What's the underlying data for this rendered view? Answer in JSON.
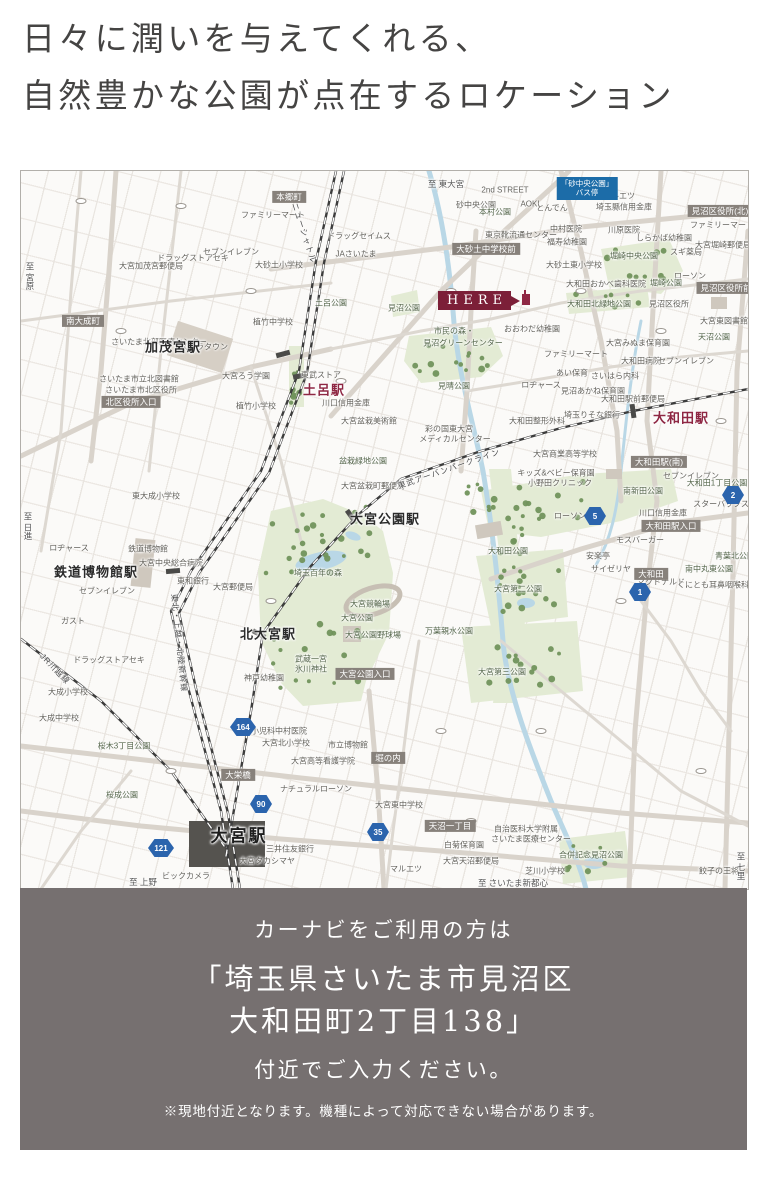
{
  "header": {
    "line1": "日々に潤いを与えてくれる、",
    "line2": "自然豊かな公園が点在するロケーション"
  },
  "footer": {
    "line1": "カーナビをご利用の方は",
    "line2": "「埼玉県さいたま市見沼区",
    "line3": "大和田町2丁目138」",
    "line4": "付近でご入力ください。",
    "note": "※現地付近となります。機種によって対応できない場合があります。"
  },
  "colors": {
    "accent_red": "#7c1f38",
    "station_red": "#8e2743",
    "badge_gray": "#87817b",
    "route_blue": "#2b64ad",
    "footer_bg": "#767070",
    "park_green": "#e3ebd4",
    "tree_green": "#71945c",
    "water_blue": "#b9d7e6"
  },
  "map": {
    "here": {
      "label": "HERE"
    },
    "stations": [
      {
        "t": "加茂宮駅",
        "cls": "sta",
        "x": 152,
        "y": 175
      },
      {
        "t": "土呂駅",
        "cls": "sta-red",
        "x": 303,
        "y": 218
      },
      {
        "t": "大和田駅",
        "cls": "sta-red",
        "x": 660,
        "y": 246
      },
      {
        "t": "鉄道博物館駅",
        "cls": "sta",
        "x": 75,
        "y": 400
      },
      {
        "t": "北大宮駅",
        "cls": "sta",
        "x": 247,
        "y": 462
      },
      {
        "t": "大宮公園駅",
        "cls": "sta",
        "x": 364,
        "y": 347
      },
      {
        "t": "大宮駅",
        "cls": "sta-big",
        "x": 218,
        "y": 663
      }
    ],
    "gray_badges": [
      {
        "t": "本郷町",
        "x": 268,
        "y": 26
      },
      {
        "t": "南大成町",
        "x": 62,
        "y": 150
      },
      {
        "t": "北区役所入口",
        "x": 110,
        "y": 231
      },
      {
        "t": "大砂土中学校前",
        "x": 465,
        "y": 78
      },
      {
        "t": "見沼区役所(北)",
        "x": 699,
        "y": 40
      },
      {
        "t": "見沼区役所前",
        "x": 705,
        "y": 117
      },
      {
        "t": "大宮公園入口",
        "x": 344,
        "y": 503
      },
      {
        "t": "大和田駅(南)",
        "x": 638,
        "y": 291
      },
      {
        "t": "大和田駅入口",
        "x": 650,
        "y": 355
      },
      {
        "t": "大和田",
        "x": 630,
        "y": 403
      },
      {
        "t": "大栄橋",
        "x": 217,
        "y": 604
      },
      {
        "t": "堀の内",
        "x": 367,
        "y": 587
      },
      {
        "t": "天沼一丁目",
        "x": 429,
        "y": 655
      }
    ],
    "route_badges": [
      {
        "n": "90",
        "x": 240,
        "y": 633
      },
      {
        "n": "121",
        "x": 140,
        "y": 677
      },
      {
        "n": "35",
        "x": 357,
        "y": 661
      },
      {
        "n": "164",
        "x": 222,
        "y": 556
      },
      {
        "n": "2",
        "x": 712,
        "y": 324
      },
      {
        "n": "5",
        "x": 574,
        "y": 345
      },
      {
        "n": "1",
        "x": 619,
        "y": 421
      }
    ],
    "bus_badge": {
      "l1": "「砂中央公園」",
      "l2": "バス停",
      "x": 566,
      "y": 6
    },
    "rail_names": [
      {
        "t": "ニューシャトル",
        "x": 283,
        "y": 62,
        "r": 72
      },
      {
        "t": "JR川越線",
        "x": 34,
        "y": 498,
        "r": 46
      },
      {
        "t": "東北・上越・北陸新幹線",
        "x": 158,
        "y": 472,
        "r": 84
      },
      {
        "t": "東武アーバンパークライン",
        "x": 428,
        "y": 298,
        "r": -19
      }
    ],
    "directions": [
      {
        "t": "至 東大宮",
        "x": 425,
        "y": 13,
        "v": false
      },
      {
        "t": "至 宮原",
        "x": 9,
        "y": 105,
        "v": true
      },
      {
        "t": "至 日進",
        "x": 7,
        "y": 355,
        "v": true
      },
      {
        "t": "至 上野",
        "x": 122,
        "y": 711,
        "v": false
      },
      {
        "t": "至 さいたま新都心",
        "x": 492,
        "y": 712,
        "v": false
      },
      {
        "t": "至 七里",
        "x": 720,
        "y": 695,
        "v": true
      }
    ],
    "parks": [
      {
        "t": "見沼公園",
        "x": 383,
        "y": 137
      },
      {
        "t": "市民の森・",
        "x": 433,
        "y": 160
      },
      {
        "t": "見沼グリーンセンター",
        "x": 442,
        "y": 172
      },
      {
        "t": "見晴公園",
        "x": 433,
        "y": 215
      },
      {
        "t": "大和田北緑地公園",
        "x": 578,
        "y": 133
      },
      {
        "t": "堀崎中央公園",
        "x": 613,
        "y": 85
      },
      {
        "t": "堀崎公園",
        "x": 645,
        "y": 112
      },
      {
        "t": "大和田公園",
        "x": 487,
        "y": 380
      },
      {
        "t": "大宮第二公園",
        "x": 497,
        "y": 418
      },
      {
        "t": "大宮第三公園",
        "x": 481,
        "y": 501
      },
      {
        "t": "万葉親水公園",
        "x": 428,
        "y": 460
      },
      {
        "t": "埼玉百年の森",
        "x": 297,
        "y": 402
      },
      {
        "t": "大宮競輪場",
        "x": 349,
        "y": 433
      },
      {
        "t": "大宮公園",
        "x": 336,
        "y": 447
      },
      {
        "t": "大宮公園野球場",
        "x": 352,
        "y": 464
      },
      {
        "t": "武蔵一宮",
        "x": 290,
        "y": 488
      },
      {
        "t": "氷川神社",
        "x": 290,
        "y": 498
      },
      {
        "t": "合併記念見沼公園",
        "x": 570,
        "y": 684
      },
      {
        "t": "本村公園",
        "x": 474,
        "y": 41
      },
      {
        "t": "土呂公園",
        "x": 310,
        "y": 132
      },
      {
        "t": "大和田1丁目公園",
        "x": 696,
        "y": 312
      },
      {
        "t": "南新田公園",
        "x": 622,
        "y": 320
      },
      {
        "t": "天沼公園",
        "x": 693,
        "y": 166
      },
      {
        "t": "盆栽緑地公園",
        "x": 342,
        "y": 290
      },
      {
        "t": "桜木3丁目公園",
        "x": 103,
        "y": 575
      },
      {
        "t": "桜成公園",
        "x": 101,
        "y": 624
      },
      {
        "t": "南中丸東公園",
        "x": 688,
        "y": 398
      },
      {
        "t": "青葉北公園",
        "x": 714,
        "y": 385
      }
    ],
    "places": [
      {
        "t": "大宮加茂宮郵便局",
        "x": 130,
        "y": 95
      },
      {
        "t": "ドラッグストアセキ",
        "x": 172,
        "y": 87
      },
      {
        "t": "大砂土小学校",
        "x": 258,
        "y": 94
      },
      {
        "t": "JAさいたま",
        "x": 335,
        "y": 83
      },
      {
        "t": "ドラッグセイムス",
        "x": 338,
        "y": 65
      },
      {
        "t": "セブンイレブン",
        "x": 210,
        "y": 81
      },
      {
        "t": "ファミリーマート",
        "x": 252,
        "y": 44
      },
      {
        "t": "東京靴流通センター",
        "x": 500,
        "y": 64
      },
      {
        "t": "2nd STREET",
        "x": 484,
        "y": 19
      },
      {
        "t": "AOKI",
        "x": 509,
        "y": 33
      },
      {
        "t": "とんでん",
        "x": 531,
        "y": 37
      },
      {
        "t": "マルエツ",
        "x": 598,
        "y": 25
      },
      {
        "t": "埼玉縣信用金庫",
        "x": 603,
        "y": 36
      },
      {
        "t": "砂中央公園",
        "x": 455,
        "y": 34
      },
      {
        "t": "中村医院",
        "x": 545,
        "y": 58
      },
      {
        "t": "川原医院",
        "x": 603,
        "y": 59
      },
      {
        "t": "しらかば幼稚園",
        "x": 643,
        "y": 67
      },
      {
        "t": "福寿幼稚園",
        "x": 546,
        "y": 71
      },
      {
        "t": "大砂土東小学校",
        "x": 553,
        "y": 94
      },
      {
        "t": "ファミリーマート",
        "x": 701,
        "y": 54
      },
      {
        "t": "スギ薬局",
        "x": 665,
        "y": 81
      },
      {
        "t": "大宮堀崎郵便局",
        "x": 702,
        "y": 74
      },
      {
        "t": "ローソン",
        "x": 669,
        "y": 105
      },
      {
        "t": "植竹中学校",
        "x": 252,
        "y": 151
      },
      {
        "t": "植竹小学校",
        "x": 235,
        "y": 235
      },
      {
        "t": "東武ストア",
        "x": 300,
        "y": 204
      },
      {
        "t": "川口信用金庫",
        "x": 325,
        "y": 232
      },
      {
        "t": "さいたま北部医療センター",
        "x": 138,
        "y": 171
      },
      {
        "t": "ステラタウン",
        "x": 183,
        "y": 176
      },
      {
        "t": "さいたま市立北図書館",
        "x": 118,
        "y": 208
      },
      {
        "t": "さいたま市北区役所",
        "x": 120,
        "y": 219
      },
      {
        "t": "大宮ろう学園",
        "x": 225,
        "y": 205
      },
      {
        "t": "見沼区役所",
        "x": 648,
        "y": 133
      },
      {
        "t": "大宮東図書館",
        "x": 703,
        "y": 150
      },
      {
        "t": "大宮みぬま保育園",
        "x": 617,
        "y": 172
      },
      {
        "t": "大和田病院",
        "x": 620,
        "y": 190
      },
      {
        "t": "セブンイレブン",
        "x": 665,
        "y": 190
      },
      {
        "t": "大和田おかべ歯科医院",
        "x": 585,
        "y": 113
      },
      {
        "t": "おおわだ幼稚園",
        "x": 511,
        "y": 158
      },
      {
        "t": "ファミリーマート",
        "x": 555,
        "y": 183
      },
      {
        "t": "あい保育",
        "x": 551,
        "y": 202
      },
      {
        "t": "さいはら内科",
        "x": 594,
        "y": 205
      },
      {
        "t": "ロヂャース",
        "x": 520,
        "y": 214
      },
      {
        "t": "見沼あかね保育園",
        "x": 572,
        "y": 220
      },
      {
        "t": "大和田駅前郵便局",
        "x": 612,
        "y": 228
      },
      {
        "t": "埼玉りそな銀行",
        "x": 571,
        "y": 244
      },
      {
        "t": "彩の国東大宮",
        "x": 428,
        "y": 258
      },
      {
        "t": "メディカルセンター",
        "x": 434,
        "y": 268
      },
      {
        "t": "大和田整形外科",
        "x": 516,
        "y": 250
      },
      {
        "t": "大宮商業高等学校",
        "x": 544,
        "y": 283
      },
      {
        "t": "キッズ&ベビー保育園",
        "x": 535,
        "y": 302
      },
      {
        "t": "小野田クリニック",
        "x": 539,
        "y": 312
      },
      {
        "t": "大宮盆栽美術館",
        "x": 348,
        "y": 250
      },
      {
        "t": "大宮盆栽町郵便局",
        "x": 352,
        "y": 315
      },
      {
        "t": "スターバックス",
        "x": 700,
        "y": 333
      },
      {
        "t": "セブンイレブン",
        "x": 670,
        "y": 305
      },
      {
        "t": "川口信用金庫",
        "x": 642,
        "y": 342
      },
      {
        "t": "ローソン",
        "x": 549,
        "y": 345
      },
      {
        "t": "モスバーガー",
        "x": 619,
        "y": 369
      },
      {
        "t": "安楽亭",
        "x": 577,
        "y": 385
      },
      {
        "t": "サイゼリヤ",
        "x": 590,
        "y": 398
      },
      {
        "t": "マクドナルド",
        "x": 640,
        "y": 411
      },
      {
        "t": "くにとも耳鼻咽喉科",
        "x": 692,
        "y": 414
      },
      {
        "t": "鉄道博物館",
        "x": 127,
        "y": 378
      },
      {
        "t": "大宮中央総合病院",
        "x": 150,
        "y": 392
      },
      {
        "t": "東和銀行",
        "x": 172,
        "y": 410
      },
      {
        "t": "大宮郵便局",
        "x": 212,
        "y": 416
      },
      {
        "t": "セブンイレブン",
        "x": 86,
        "y": 420
      },
      {
        "t": "ロヂャース",
        "x": 48,
        "y": 377
      },
      {
        "t": "ガスト",
        "x": 52,
        "y": 450
      },
      {
        "t": "ドラッグストアセキ",
        "x": 88,
        "y": 489
      },
      {
        "t": "東大成小学校",
        "x": 135,
        "y": 325
      },
      {
        "t": "大成小学校",
        "x": 47,
        "y": 521
      },
      {
        "t": "大成中学校",
        "x": 38,
        "y": 547
      },
      {
        "t": "神戸幼稚園",
        "x": 243,
        "y": 507
      },
      {
        "t": "小児科中村医院",
        "x": 258,
        "y": 560
      },
      {
        "t": "大宮北小学校",
        "x": 265,
        "y": 572
      },
      {
        "t": "市立博物館",
        "x": 327,
        "y": 574
      },
      {
        "t": "大宮高等看護学院",
        "x": 302,
        "y": 590
      },
      {
        "t": "ナチュラルローソン",
        "x": 295,
        "y": 618
      },
      {
        "t": "三井住友銀行",
        "x": 269,
        "y": 678
      },
      {
        "t": "大宮タカシマヤ",
        "x": 246,
        "y": 690
      },
      {
        "t": "ビックカメラ",
        "x": 165,
        "y": 705
      },
      {
        "t": "大宮東中学校",
        "x": 378,
        "y": 634
      },
      {
        "t": "白菊保育園",
        "x": 443,
        "y": 674
      },
      {
        "t": "大宮天沼郵便局",
        "x": 450,
        "y": 690
      },
      {
        "t": "自治医科大学附属",
        "x": 505,
        "y": 658
      },
      {
        "t": "さいたま医療センター",
        "x": 510,
        "y": 668
      },
      {
        "t": "芝川小学校",
        "x": 524,
        "y": 700
      },
      {
        "t": "マルエツ",
        "x": 385,
        "y": 698
      },
      {
        "t": "餃子の王将",
        "x": 698,
        "y": 700
      }
    ]
  }
}
